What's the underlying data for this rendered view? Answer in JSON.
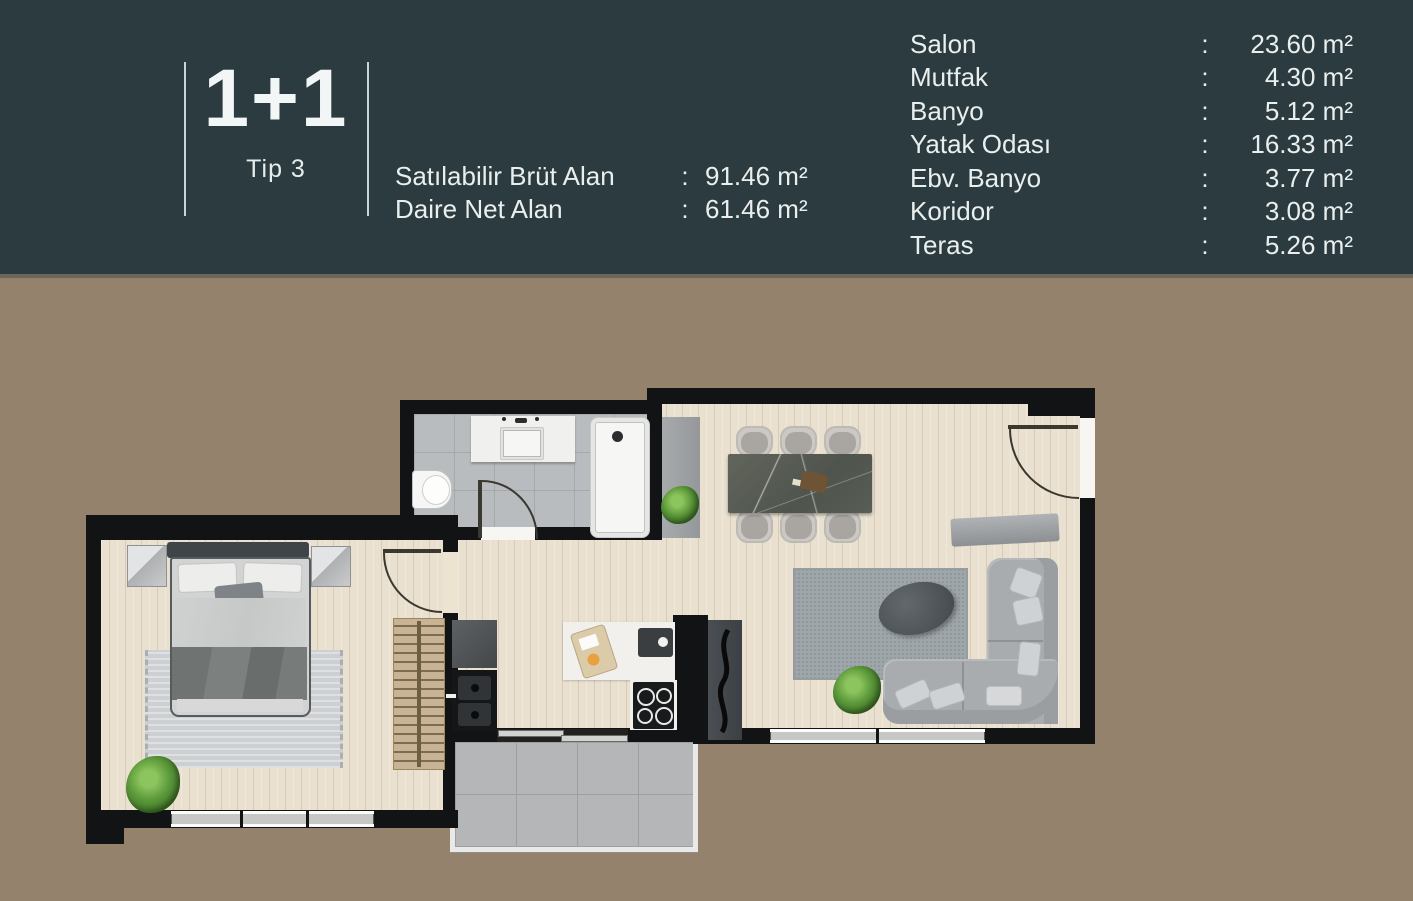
{
  "header": {
    "type_label": "1+1",
    "type_sub": "Tip 3",
    "colon": ":",
    "left_rows": [
      {
        "label": "Satılabilir Brüt Alan",
        "value": "91.46 m²"
      },
      {
        "label": "Daire Net Alan",
        "value": "61.46 m²"
      }
    ],
    "rooms": [
      {
        "label": "Salon",
        "value": "23.60 m²"
      },
      {
        "label": "Mutfak",
        "value": "4.30 m²"
      },
      {
        "label": "Banyo",
        "value": "5.12 m²"
      },
      {
        "label": "Yatak Odası",
        "value": "16.33 m²"
      },
      {
        "label": "Ebv. Banyo",
        "value": "3.77 m²"
      },
      {
        "label": "Koridor",
        "value": "3.08 m²"
      },
      {
        "label": "Teras",
        "value": "5.26 m²"
      }
    ]
  },
  "colors": {
    "header_bg": "#2c3b3f",
    "page_bg": "#94826d",
    "wall": "#121315",
    "wood_floor": "#e9e0cf",
    "bath_tile": "#b9bcbe",
    "terrace_tile": "#b4b6b7",
    "text": "#e9efee"
  }
}
